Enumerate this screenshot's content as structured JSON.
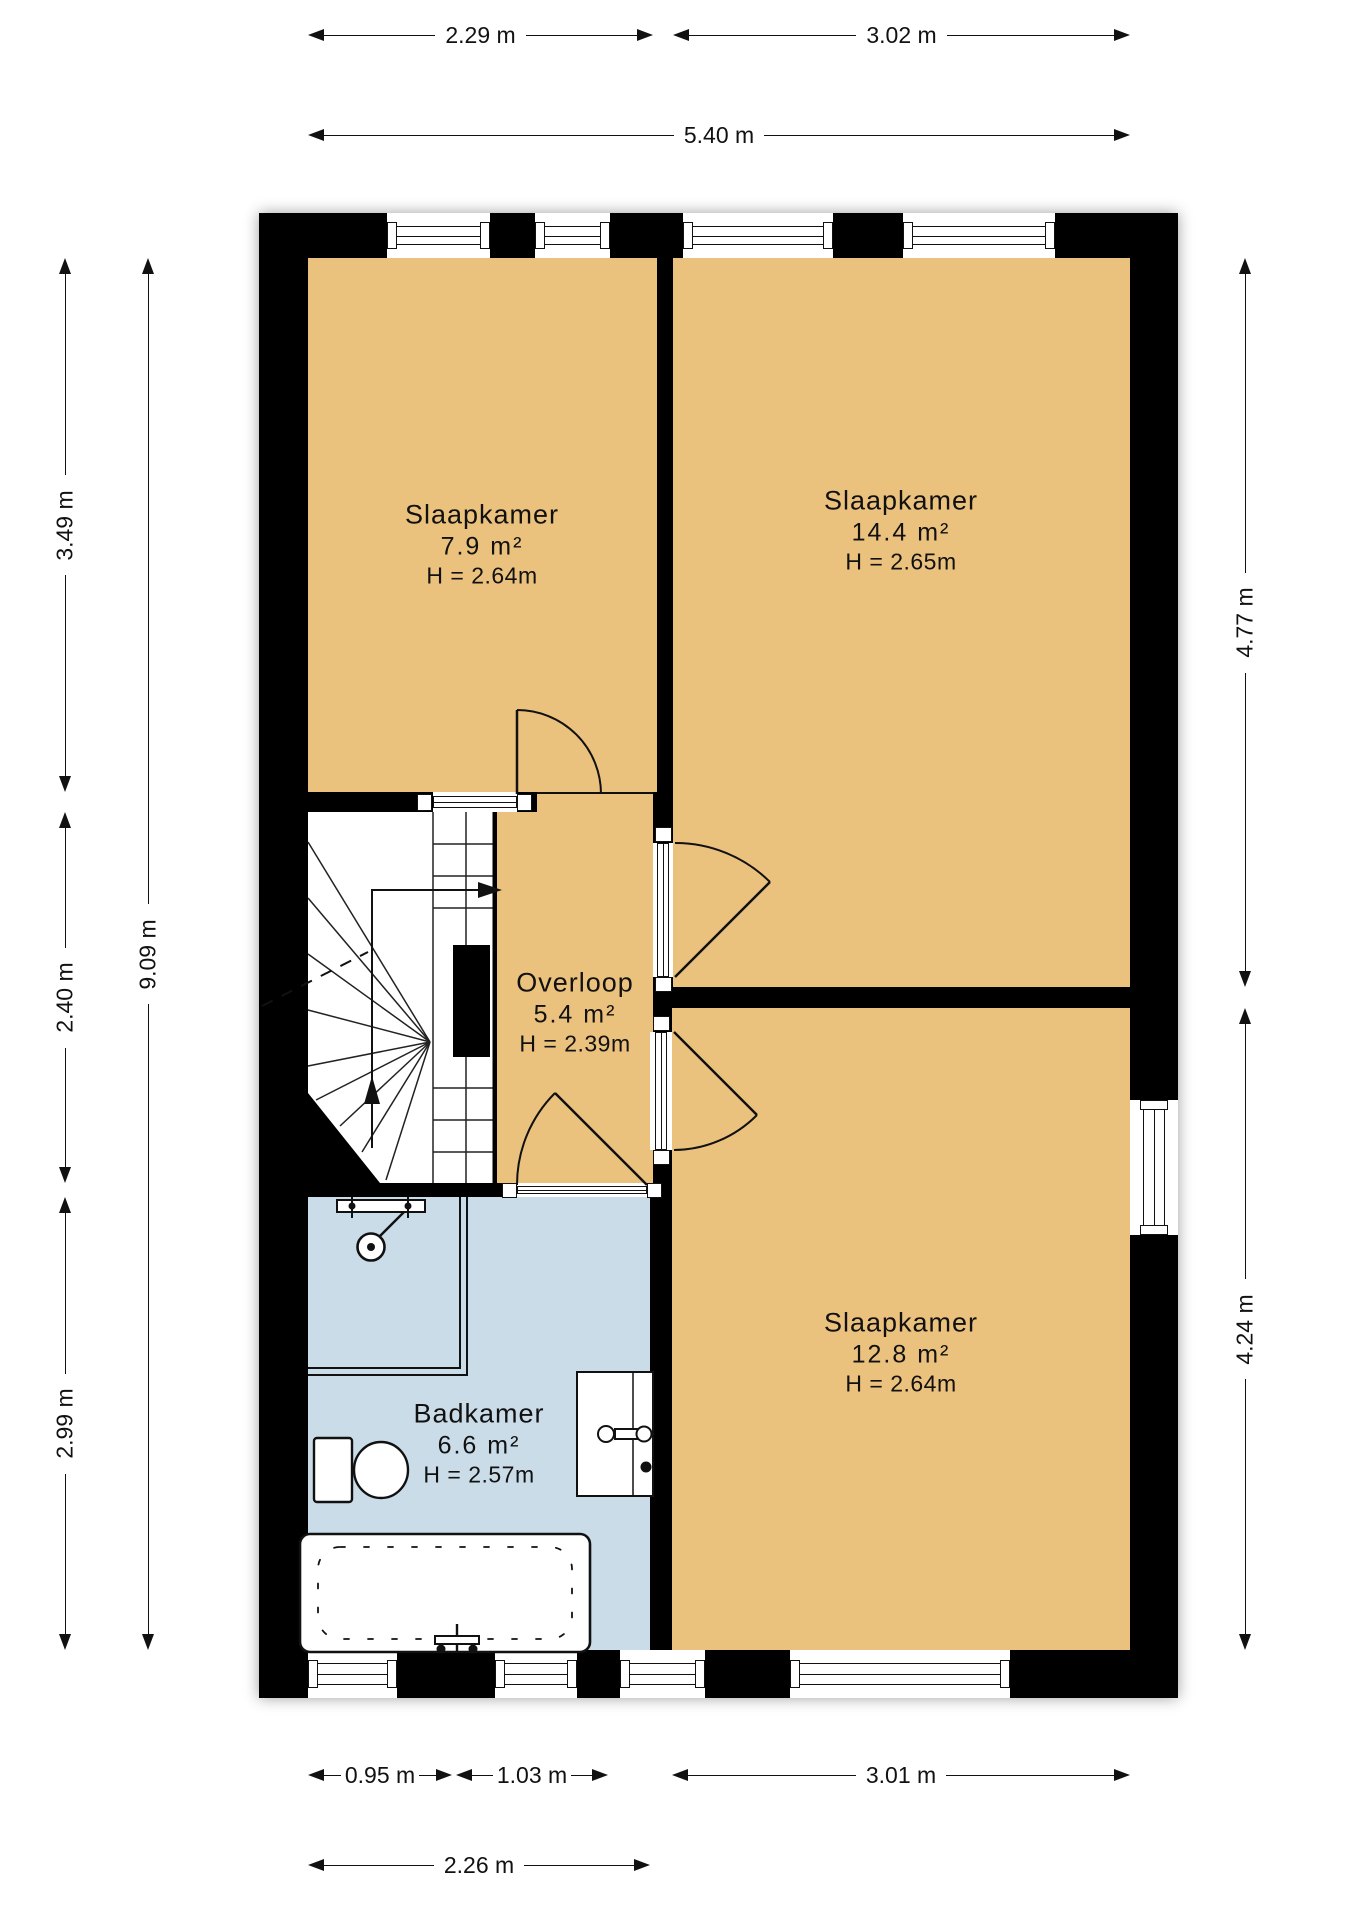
{
  "plan": {
    "title": "floor plan - first floor",
    "rooms": [
      {
        "id": "slaapkamer-1",
        "name": "Slaapkamer",
        "area": "7.9 m²",
        "height": "H = 2.64m"
      },
      {
        "id": "slaapkamer-2",
        "name": "Slaapkamer",
        "area": "14.4 m²",
        "height": "H = 2.65m"
      },
      {
        "id": "overloop",
        "name": "Overloop",
        "area": "5.4 m²",
        "height": "H = 2.39m"
      },
      {
        "id": "slaapkamer-3",
        "name": "Slaapkamer",
        "area": "12.8 m²",
        "height": "H = 2.64m"
      },
      {
        "id": "badkamer",
        "name": "Badkamer",
        "area": "6.6 m²",
        "height": "H = 2.57m"
      }
    ],
    "dimensions": {
      "top_segments": [
        "2.29 m",
        "3.02 m"
      ],
      "top_total": "5.40 m",
      "left_segments": [
        "3.49 m",
        "2.40 m",
        "2.99 m"
      ],
      "left_total": "9.09 m",
      "right_segments": [
        "4.77 m",
        "4.24 m"
      ],
      "bottom_segments": [
        "0.95 m",
        "1.03 m",
        "3.01 m"
      ],
      "bottom_total": "2.26 m"
    },
    "colors": {
      "wall": "#000000",
      "room_fill": "#EBC17E",
      "bathroom_fill": "#CBDCE9",
      "stairs_fill": "#FFFFFF",
      "line": "#111111"
    }
  }
}
